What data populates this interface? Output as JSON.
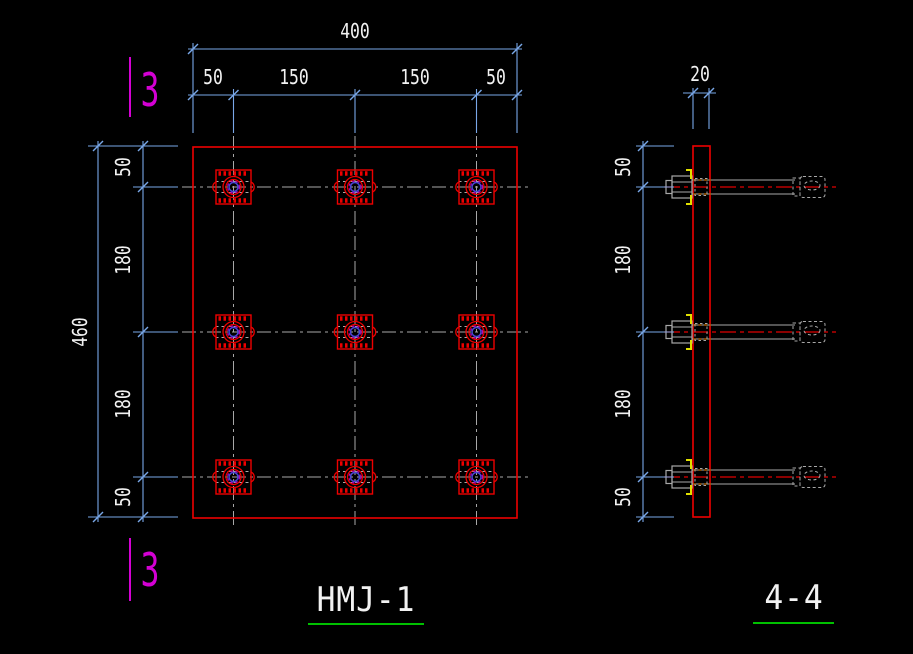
{
  "app": {
    "type": "cad-drawing-viewport",
    "background": "#000000"
  },
  "colors": {
    "dimension_blue": "#79a7e8",
    "entity_red": "#ee0000",
    "centerline_gray": "#a8a8a8",
    "text_white": "#f2f2f2",
    "section_magenta": "#d400d4",
    "underline_green": "#00c000",
    "washer_yellow": "#e0e000",
    "hidden_orange": "#a85b00",
    "bolt_blue": "#4747d6",
    "bolt_magenta": "#bb00bb"
  },
  "plan": {
    "title": "HMJ-1",
    "section_label": "3",
    "dim_top": {
      "overall": "400",
      "segments": [
        "50",
        "150",
        "150",
        "50"
      ]
    },
    "dim_left": {
      "overall": "460",
      "segments": [
        "50",
        "180",
        "180",
        "50"
      ]
    },
    "bolt_grid": {
      "rows": 3,
      "cols": 3
    }
  },
  "section": {
    "title": "4-4",
    "dim_top": {
      "plate_thickness": "20"
    },
    "dim_left": {
      "segments": [
        "50",
        "180",
        "180",
        "50"
      ]
    },
    "bolt_count": 3
  }
}
